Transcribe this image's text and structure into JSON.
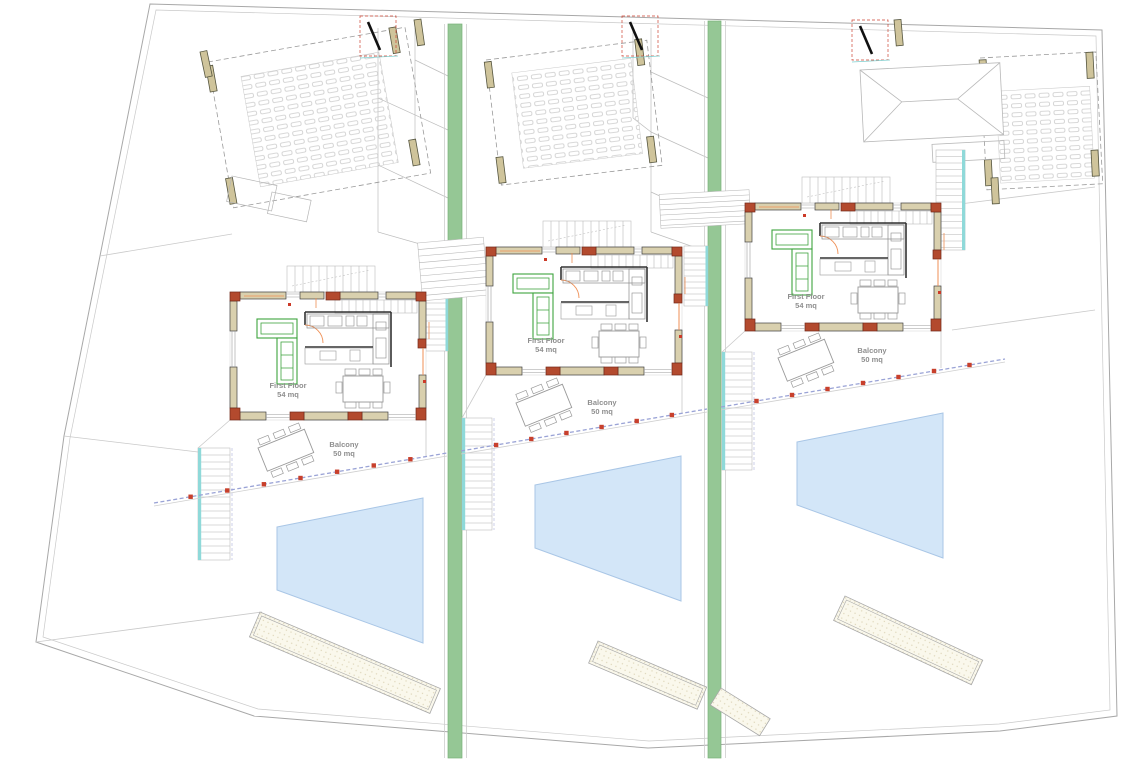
{
  "villas": [
    {
      "id": "villa-1",
      "first_floor_label": "First Floor",
      "first_floor_area": "54 mq",
      "balcony_label": "Balcony",
      "balcony_area": "50 mq"
    },
    {
      "id": "villa-2",
      "first_floor_label": "First Floor",
      "first_floor_area": "54 mq",
      "balcony_label": "Balcony",
      "balcony_area": "50 mq"
    },
    {
      "id": "villa-3",
      "first_floor_label": "First Floor",
      "first_floor_area": "54 mq",
      "balcony_label": "Balcony",
      "balcony_area": "50 mq"
    }
  ],
  "colors": {
    "greenway": "#95c795",
    "pool_fill": "#d3e6f8",
    "pool_stroke": "#a9c6e6",
    "wall_fill": "#d9d0ae",
    "brick_pier": "#b34a2e",
    "railing_dash": "#9aa3d6",
    "railing_post": "#c8402c",
    "stair_accent": "#8fd9d9",
    "dimension_line": "#ef8f55",
    "sofa_outline": "#3ea43e"
  }
}
